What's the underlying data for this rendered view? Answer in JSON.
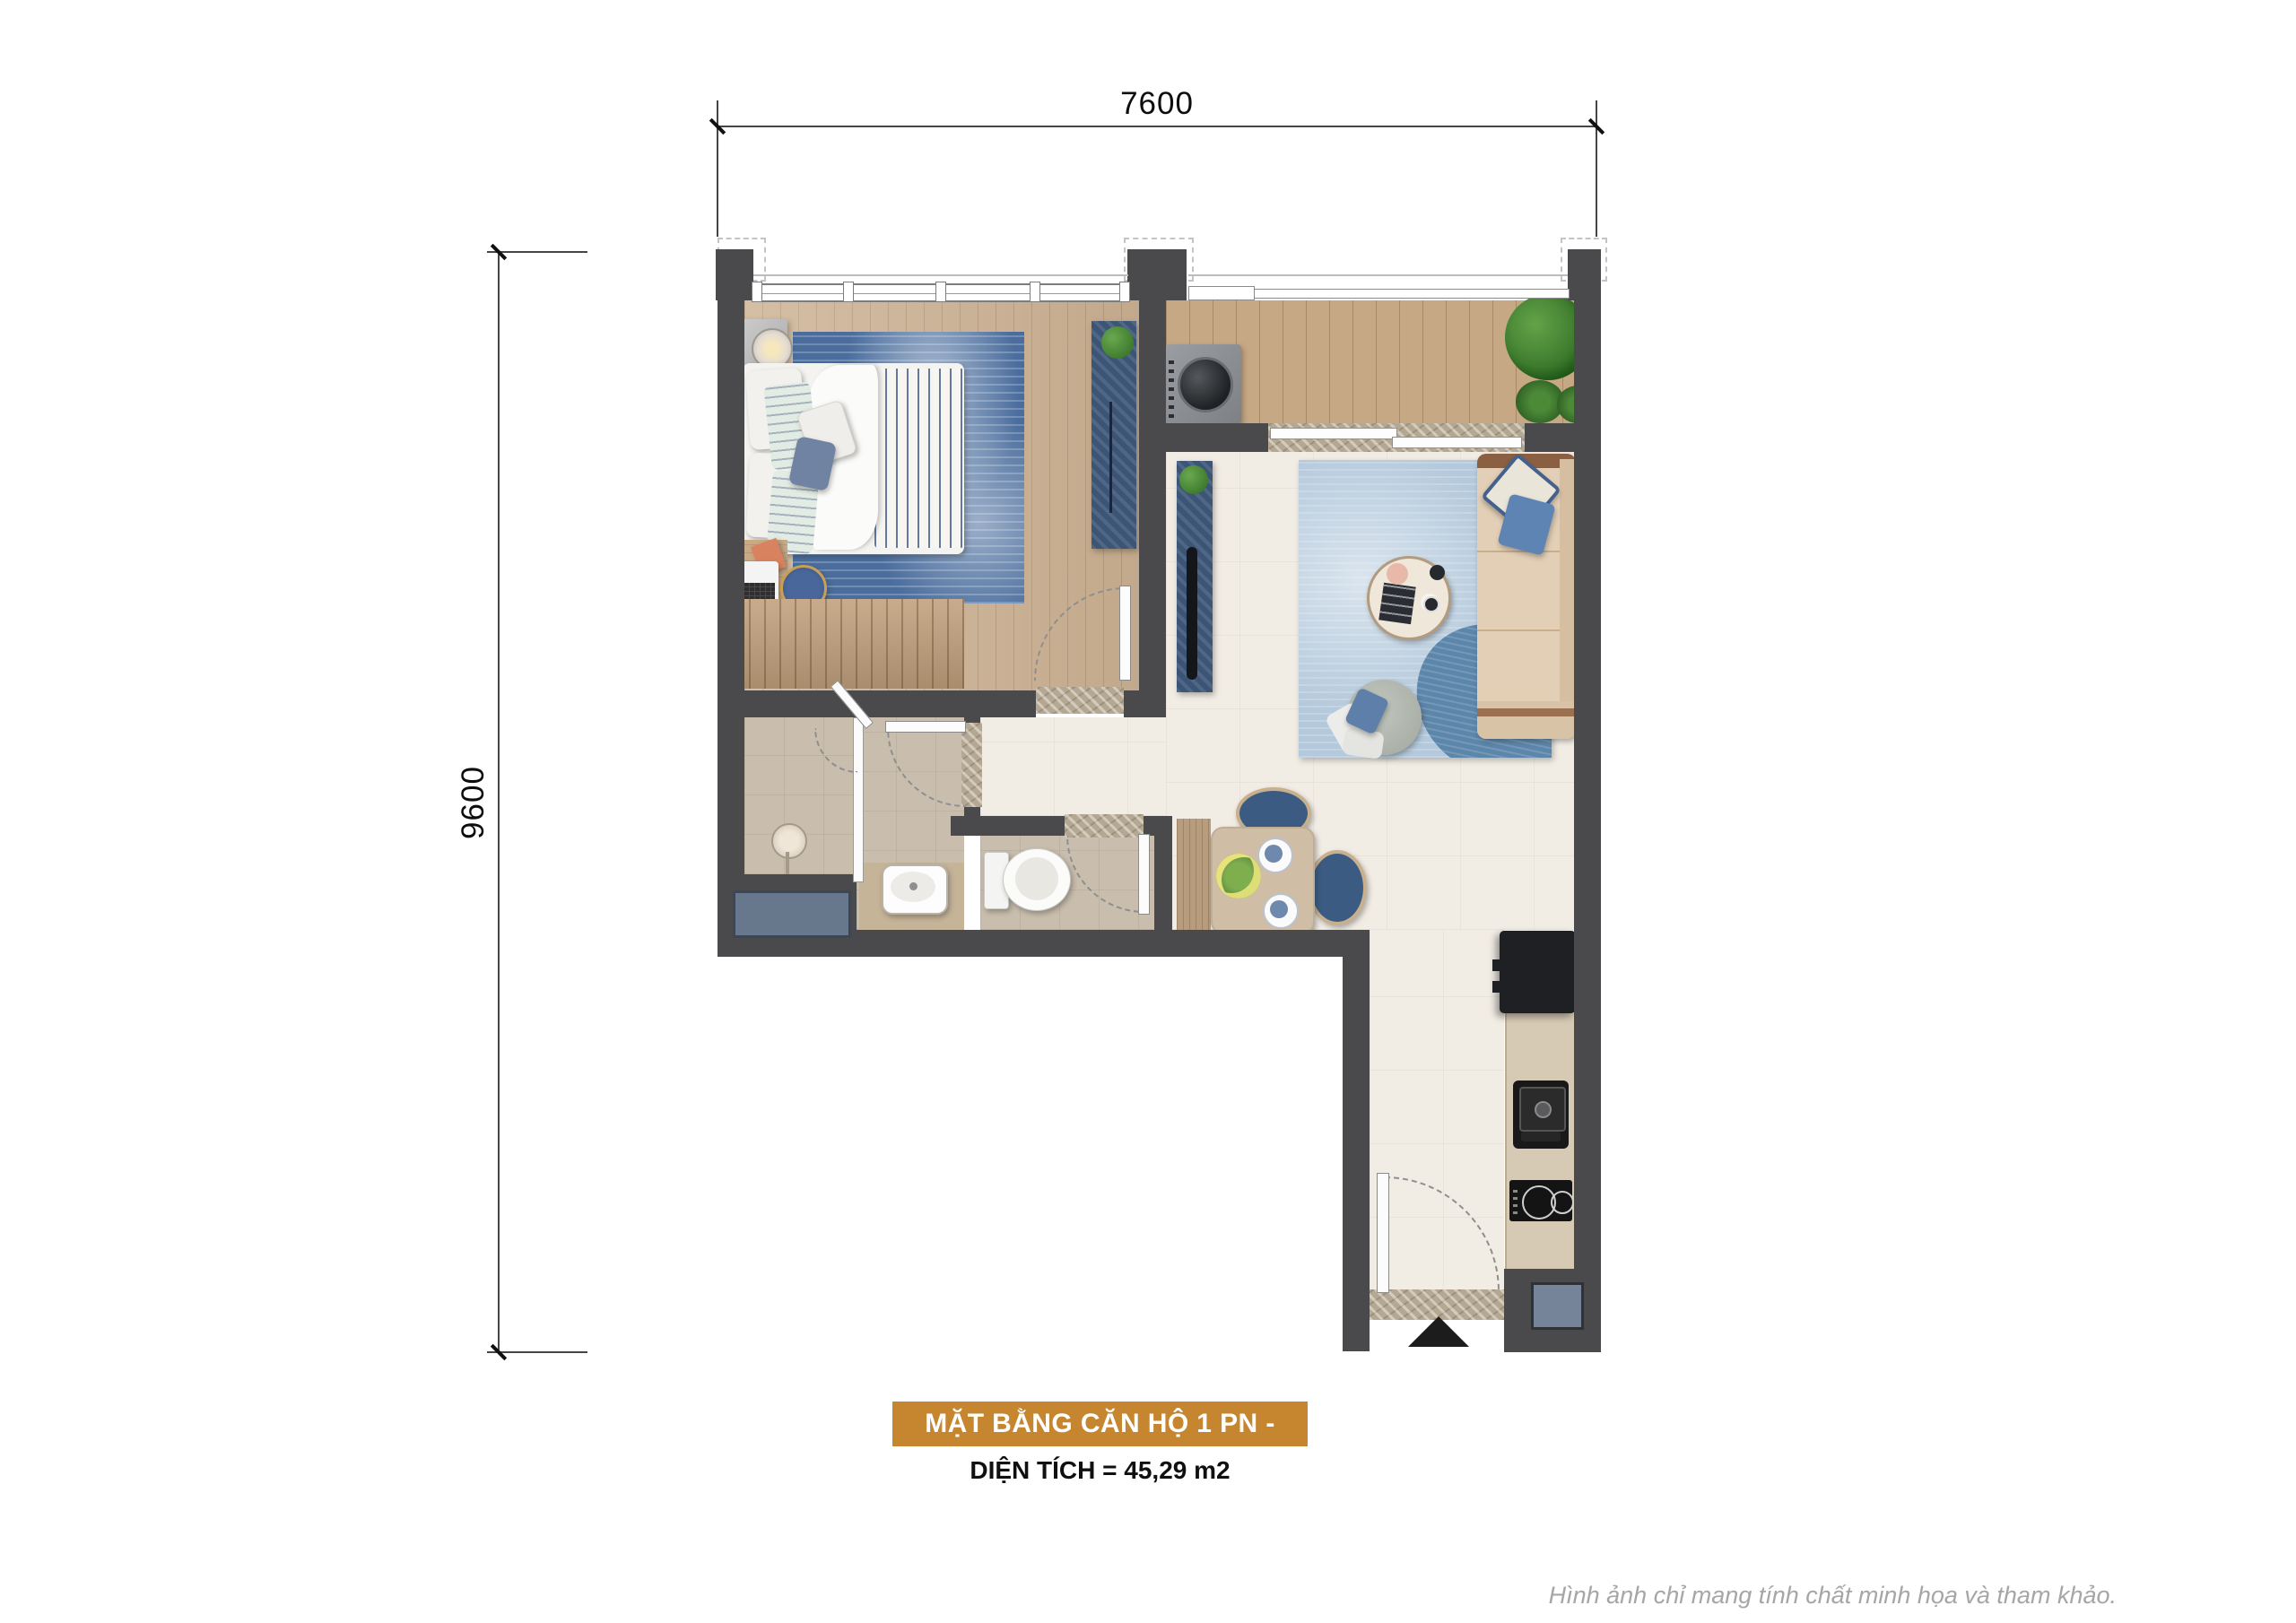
{
  "dimensions": {
    "top": "7600",
    "left": "9600"
  },
  "title_block": {
    "title": "MẶT BẰNG CĂN HỘ 1 PN - LOẠI A1",
    "area": "DIỆN TÍCH = 45,29 m2",
    "banner_color": "#C6862F"
  },
  "footer": {
    "disclaimer": "Hình ảnh chỉ mang tính chất minh họa và tham khảo."
  },
  "colors": {
    "wall": "#4A4A4C",
    "wood_floor": "#CBB091",
    "balcony_deck": "#C7A884",
    "living_tile": "#F1ECE4",
    "bath_tile": "#C9BEAD",
    "bedroom_rug": "#4A6D9D",
    "living_rug": "#B4C9DC",
    "navy_furniture": "#3C5577",
    "sofa": "#E3CFB6",
    "technical_ledge": "#74829A"
  }
}
